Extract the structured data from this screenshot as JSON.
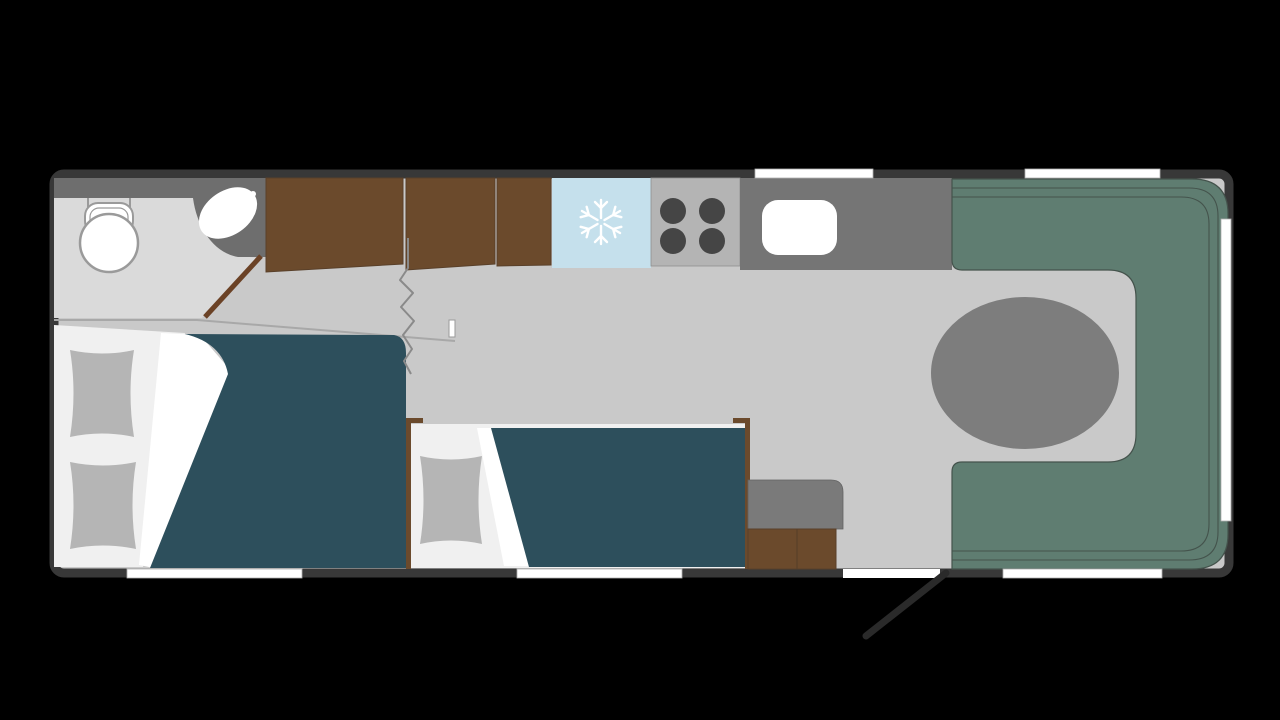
{
  "plan": {
    "type": "caravan-floorplan",
    "orientation": "side-profile-top-view",
    "rooms": [
      {
        "name": "washroom",
        "items": [
          "toilet",
          "basin",
          "washroom-door"
        ]
      },
      {
        "name": "wardrobe",
        "items": [
          "wardrobe-unit-1",
          "wardrobe-unit-2",
          "wardrobe-unit-3"
        ]
      },
      {
        "name": "kitchen",
        "items": [
          "fridge",
          "hob-4-burner",
          "kitchen-sink",
          "kitchen-counter"
        ]
      },
      {
        "name": "lounge",
        "items": [
          "u-shaped-seating",
          "oval-table"
        ]
      },
      {
        "name": "bedroom",
        "items": [
          "main-bed",
          "side-bed",
          "side-cabinet",
          "privacy-curtain"
        ]
      }
    ],
    "openings": {
      "windows_top": 2,
      "windows_bottom": 3,
      "windows_rear": 1,
      "entrance_door": 1
    },
    "icons": [
      "snowflake-icon"
    ]
  },
  "palette": {
    "background": "#000000",
    "wall": "#383838",
    "floor": "#c9c9c9",
    "washroom_floor": "#dadada",
    "fixture_unit": "#6e6e6e",
    "white": "#ffffff",
    "outline": "#9a9a9a",
    "wardrobe": "#6b4a2c",
    "wardrobe_edge": "#59402a",
    "fridge": "#c5e0ec",
    "hob": "#b4b4b4",
    "hob_edge": "#8f8f8f",
    "burner": "#454545",
    "counter": "#757575",
    "lounge": "#5f7d71",
    "lounge_line": "#44534c",
    "table": "#7d7d7d",
    "mattress": "#f0f0f0",
    "pillow": "#b5b5b5",
    "duvet": "#2d4f5c",
    "fold": "#ffffff",
    "cabinet_top": "#7a7a7a",
    "cabinet_edge": "#636363",
    "door": "#6b4226",
    "door_swing": "#2a2a2a",
    "floor_line": "#a8a8a8",
    "curtain": "#8a8a8a",
    "window": "#ffffff",
    "window_frame": "#b0b0b0"
  }
}
